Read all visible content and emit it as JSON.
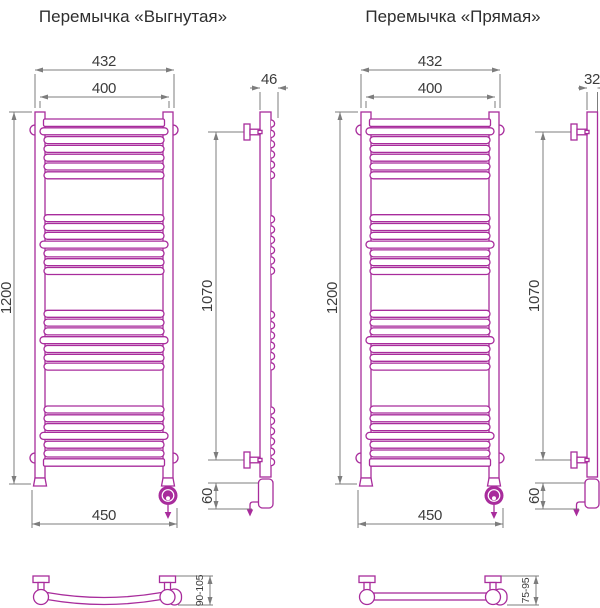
{
  "titles": {
    "curved": "Перемычка «Выгнутая»",
    "straight": "Перемычка «Прямая»"
  },
  "colors": {
    "drawing": "#a82c9c",
    "dimension_line": "#7d7d7d",
    "dimension_text": "#3d3d3d",
    "background": "#ffffff"
  },
  "curved": {
    "front": {
      "overall_width": "432",
      "barrel_width": "400",
      "height": "1200",
      "base_width": "450"
    },
    "side": {
      "depth": "46",
      "mounting_span": "1070",
      "heater_zone": "60"
    },
    "plan": {
      "wall_clearance": "90-105"
    }
  },
  "straight": {
    "front": {
      "overall_width": "432",
      "barrel_width": "400",
      "height": "1200",
      "base_width": "450"
    },
    "side": {
      "depth": "32",
      "mounting_span": "1070",
      "heater_zone": "60"
    },
    "plan": {
      "wall_clearance": "75-95"
    }
  }
}
